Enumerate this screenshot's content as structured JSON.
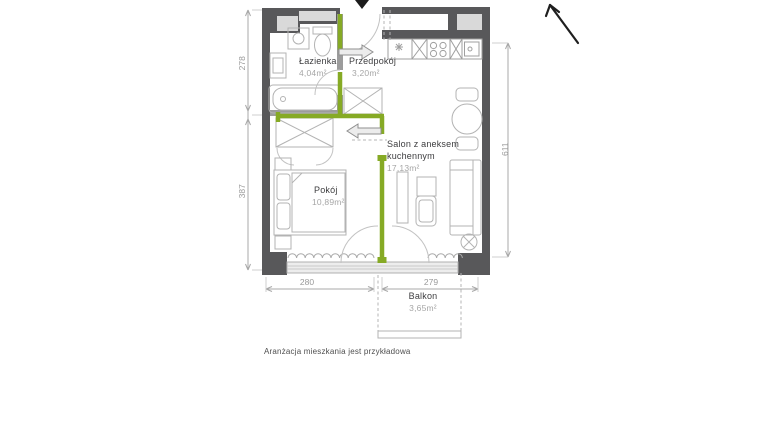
{
  "floor_plan": {
    "rooms": {
      "lazienka": {
        "name": "Łazienka",
        "area": "4,04m²"
      },
      "przedpokoj": {
        "name": "Przedpokój",
        "area": "3,20m²"
      },
      "salon": {
        "name_line1": "Salon z aneksem",
        "name_line2": "kuchennym",
        "area": "17,13m²"
      },
      "pokoj": {
        "name": "Pokój",
        "area": "10,89m²"
      },
      "balkon": {
        "name": "Balkon",
        "area": "3,65m²"
      }
    },
    "dimensions": {
      "left_upper": "278",
      "left_lower": "387",
      "right": "611",
      "bottom_left": "280",
      "bottom_right": "279"
    },
    "disclaimer": "Aranżacja mieszkania jest przykładowa",
    "colors": {
      "wall": "#58585a",
      "accent_green": "#86aa25",
      "furniture_line": "#b3b3b3",
      "dimension_line": "#9e9e9e",
      "shaft_fill": "#d9d9d9"
    }
  }
}
